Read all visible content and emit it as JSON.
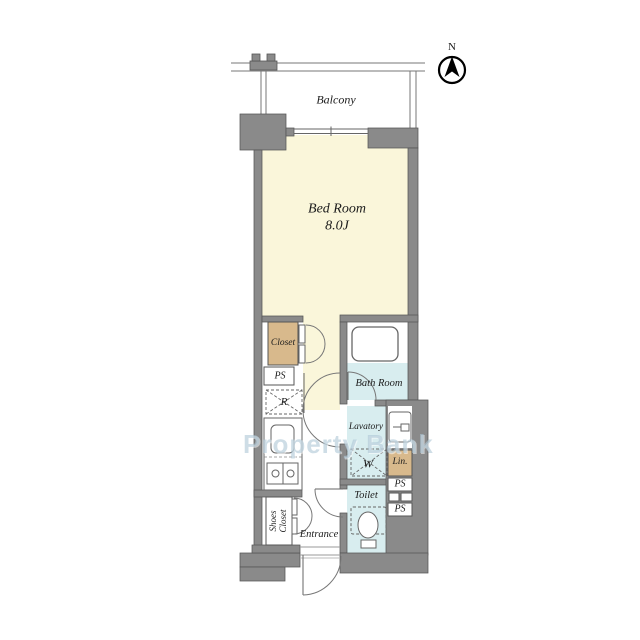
{
  "title": "Floor Plan",
  "colors": {
    "wall": "#8a8a8a",
    "wall_border": "#555555",
    "room_cream": "#FAF6DA",
    "room_blue": "#D8EDEF",
    "closet_tan": "#D8B98C",
    "line": "#666666",
    "watermark": "rgba(173,199,214,0.6)"
  },
  "compass": {
    "north": "N"
  },
  "labels": {
    "balcony": "Balcony",
    "bedroom_name": "Bed Room",
    "bedroom_size": "8.0J",
    "closet": "Closet",
    "ps": "PS",
    "refrigerator": "R",
    "bath": "Bath Room",
    "lavatory": "Lavatory",
    "washer": "W",
    "linen": "Lin.",
    "toilet": "Toilet",
    "shoes_line1": "Shoes",
    "shoes_line2": "Closet",
    "entrance": "Entrance"
  },
  "watermark": {
    "text": "Property Bank"
  }
}
